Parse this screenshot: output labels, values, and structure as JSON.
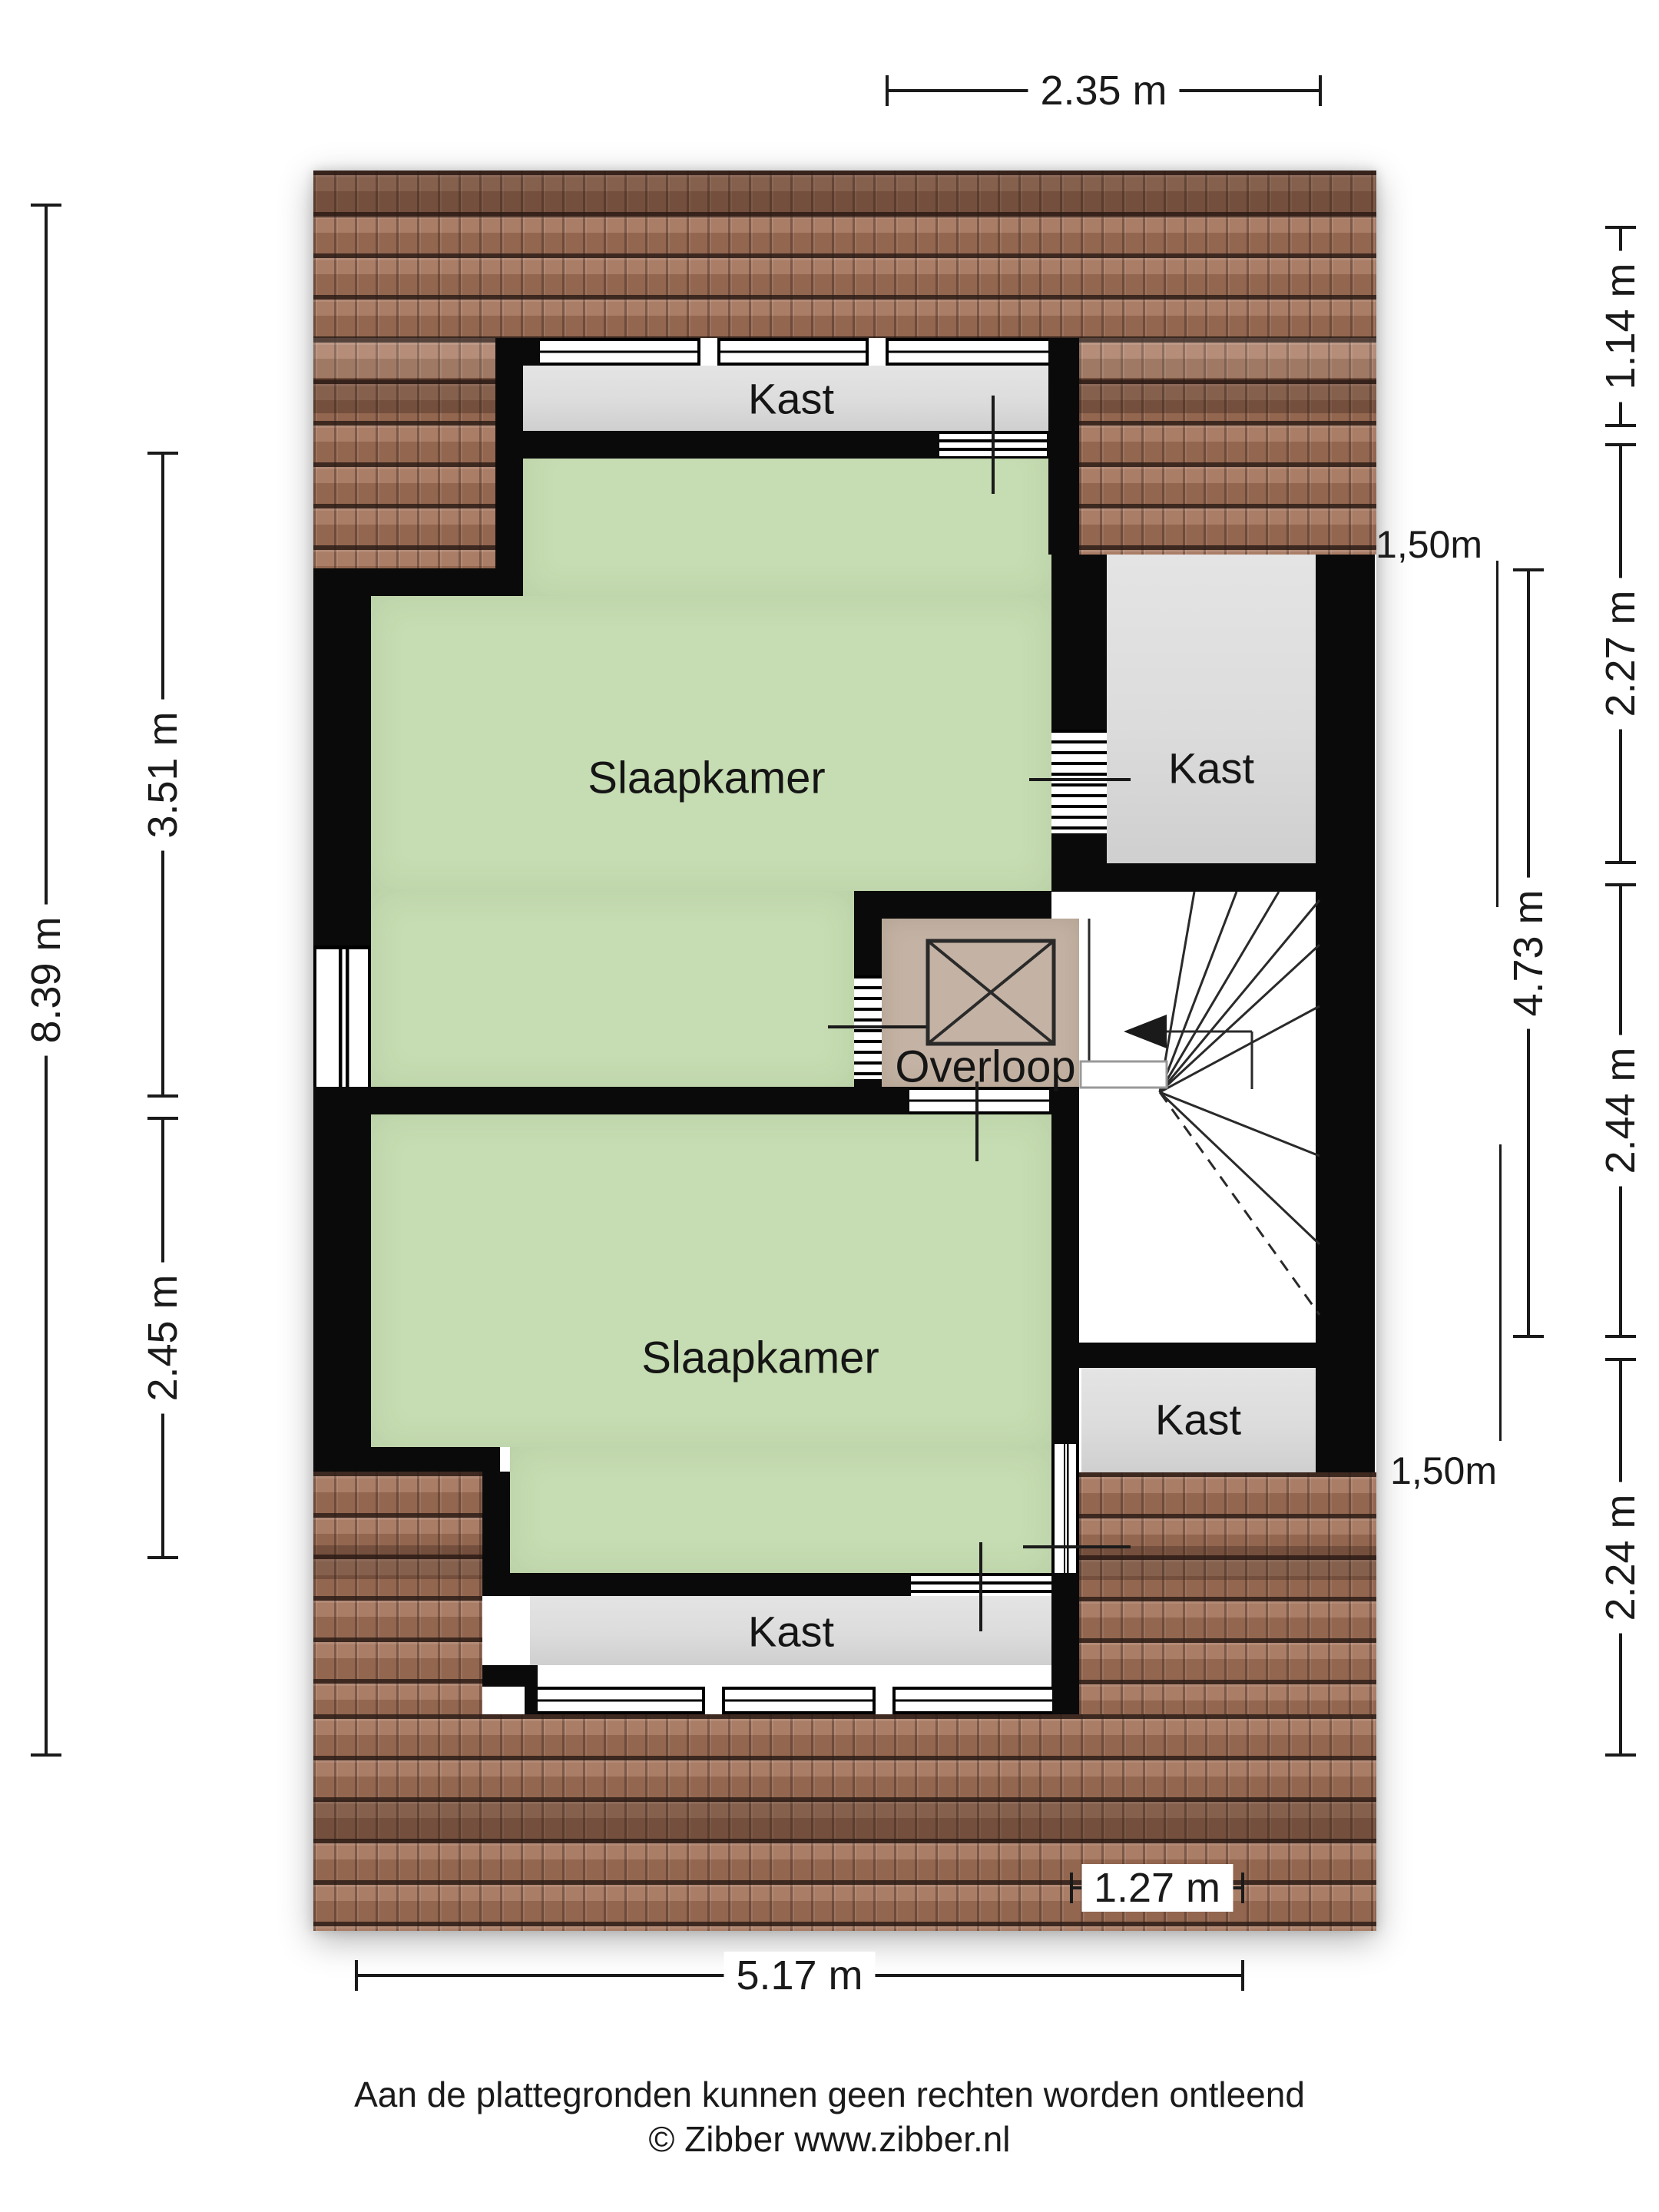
{
  "rooms": {
    "bedroom_top": "Slaapkamer",
    "bedroom_bottom": "Slaapkamer",
    "closet_top": "Kast",
    "closet_right": "Kast",
    "closet_bottom_small": "Kast",
    "closet_bottom": "Kast",
    "landing": "Overloop"
  },
  "dimensions": {
    "top_width": "2.35 m",
    "left_total_height": "8.39 m",
    "left_upper_height": "3.51 m",
    "left_lower_height": "2.45 m",
    "right_roof_overhang": "1.14 m",
    "right_upper": "2.27 m",
    "right_middle": "2.44 m",
    "right_lower": "2.24 m",
    "right_inner_total": "4.73 m",
    "bottom_inner_width": "1.27 m",
    "bottom_total_width": "5.17 m"
  },
  "height_markers": {
    "upper": "1,50m",
    "lower": "1,50m"
  },
  "footer": {
    "disclaimer": "Aan de plattegronden kunnen geen rechten worden ontleend",
    "copyright": "© Zibber www.zibber.nl"
  },
  "colors": {
    "room_green": "#c6dcb2",
    "landing_tan": "#c4b3a4",
    "closet_gray": "#dedede",
    "wall_black": "#0a0a0a",
    "roof_brown": "#9c7160",
    "dimension_line": "#1a1a1a"
  }
}
